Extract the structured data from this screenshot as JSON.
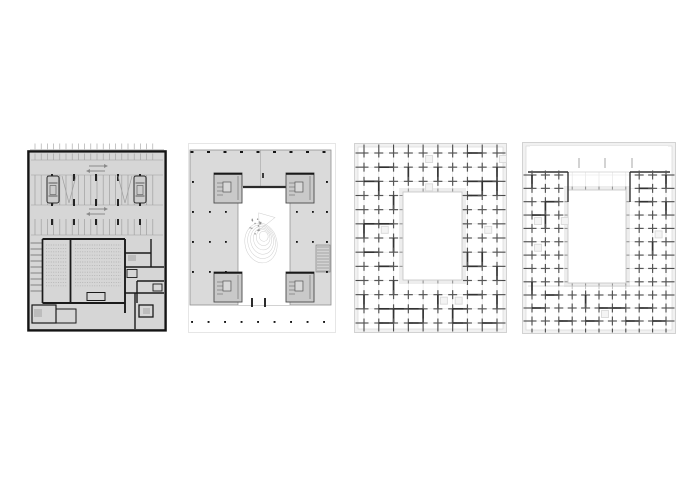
{
  "sheet": {
    "background": "#ffffff",
    "width": 700,
    "height": 495
  },
  "colors": {
    "plan1_fill": "#d6d6d6",
    "plan1_border": "#141414",
    "stall_line": "#9f9f9f",
    "wall_dark": "#1a1a1a",
    "arrow_gray": "#8a8a8a",
    "car_fill": "#cccccc",
    "seat_dot": "#b4b4b4",
    "fixture_gray": "#bcbcbc",
    "plate_gray": "#dadada",
    "plate_edge": "#8f8f8f",
    "core_gray": "#c9c9c9",
    "core_edge": "#4a4a4a",
    "page_faint": "#e0e0e0",
    "contour_gray": "#cfcfcf",
    "tree_dot": "#8f8f8f",
    "column_dot": "#161616",
    "grid_light": "#e3e3e3",
    "cross_gray": "#565656",
    "wall_medium": "#323232",
    "edge_band": "#f1f1f1",
    "edge_line": "#c9c9c9",
    "tick_dark": "#4a4a4a",
    "tick_light": "#bbbbbb",
    "court_band": "#ededed",
    "court_edge": "#c4c4c4",
    "square_light": "#d9d9d9"
  },
  "plans": [
    {
      "renderer": "parking",
      "x": 27,
      "y": 143,
      "w": 140,
      "h": 189,
      "stall_spacing": 6.2,
      "column_dash_xs": [
        25,
        47,
        69,
        91,
        113
      ],
      "car_xs": [
        20,
        107
      ],
      "arrow_center_x": 70,
      "seat_row_spacing": 3.4
    },
    {
      "renderer": "ground",
      "x": 188,
      "y": 143,
      "w": 148,
      "h": 190,
      "plate": {
        "x": 2,
        "y": 7,
        "w": 141,
        "h": 155
      },
      "courtyard": {
        "x": 50,
        "y": 44,
        "w": 52
      },
      "cores": [
        {
          "x": 26,
          "y": 30
        },
        {
          "x": 98,
          "y": 30
        },
        {
          "x": 26,
          "y": 129
        },
        {
          "x": 98,
          "y": 129
        }
      ],
      "core_size": {
        "w": 28,
        "h": 30
      },
      "stair": {
        "x": 128,
        "y": 102,
        "w": 14,
        "h": 27
      },
      "top_dot_row_y": 9,
      "bottom_dot_row_y": 178,
      "dot_xs": [
        4,
        20.5,
        37,
        53.5,
        70,
        86.5,
        103,
        119.5,
        136
      ],
      "side_dot_ys": [
        38,
        68,
        98,
        128
      ],
      "opening_dash_xs": [
        64,
        77
      ],
      "garden_center": {
        "x": 73,
        "y": 100
      },
      "seed": 5
    },
    {
      "renderer": "grid",
      "x": 354,
      "y": 143,
      "w": 153,
      "h": 190,
      "cols": 10,
      "rows": 13,
      "grid_x0": 10,
      "grid_x1": 143,
      "grid_y0": 10,
      "grid_y1": 180,
      "courtyard": {
        "x": 49,
        "y": 49,
        "w": 59,
        "h": 88
      },
      "seed": 11
    },
    {
      "renderer": "grid",
      "x": 522,
      "y": 142,
      "w": 154,
      "h": 192,
      "cols": 11,
      "grid_x0": 10,
      "grid_x1": 144,
      "wing_rows": {
        "y0": 33,
        "step": 13.35,
        "count": 9
      },
      "band_rows": [
        153,
        166,
        179
      ],
      "void_top": {
        "x": 8,
        "y": 4,
        "w": 138,
        "h": 26,
        "dashes_x": [
          57,
          83,
          110
        ],
        "dash_y0": 16,
        "dash_y1": 26
      },
      "wings": {
        "left_max_x": 44,
        "right_min_x": 110,
        "top_y": 30,
        "band_y": 144
      },
      "courtyard": {
        "x": 46,
        "y": 48,
        "w": 58,
        "h": 93
      },
      "seed": 29
    }
  ]
}
